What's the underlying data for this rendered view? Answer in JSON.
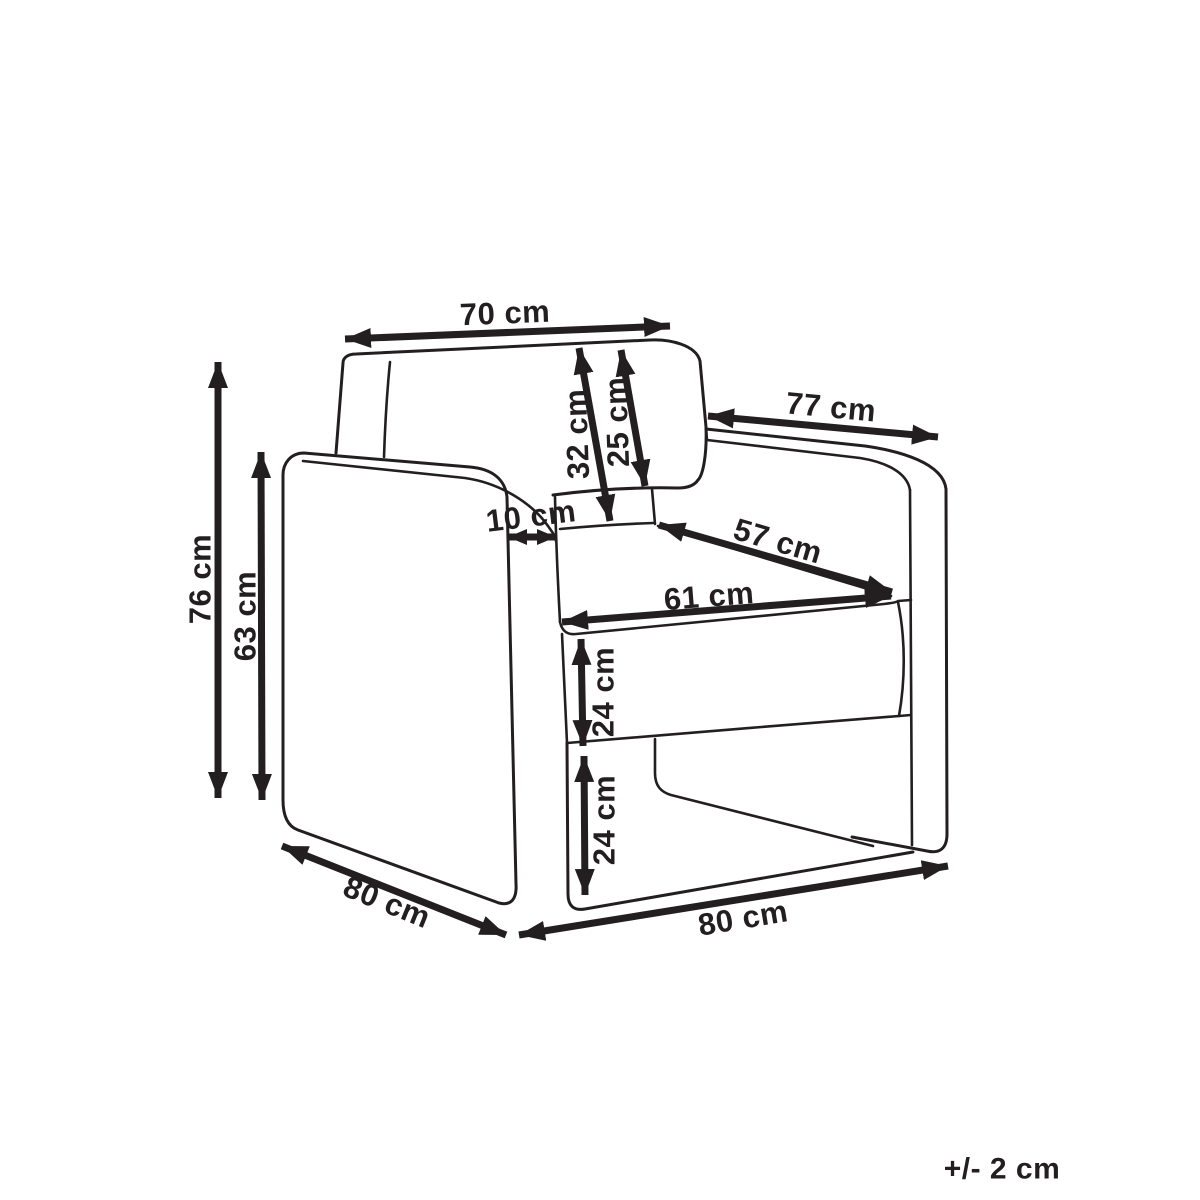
{
  "diagram": {
    "type": "furniture-dimension-drawing",
    "subject": "armchair line drawing with measurements",
    "unit": "cm",
    "tolerance_note": "+/- 2 cm",
    "colors": {
      "line": "#231f20",
      "background": "#ffffff"
    },
    "dimensions": [
      {
        "name": "backrest-width",
        "label": "70 cm"
      },
      {
        "name": "depth-along-armrest",
        "label": "77 cm"
      },
      {
        "name": "backrest-height-total",
        "label": "32 cm"
      },
      {
        "name": "backrest-panel-height",
        "label": "25 cm"
      },
      {
        "name": "armrest-thickness",
        "label": "10 cm"
      },
      {
        "name": "seat-depth",
        "label": "57 cm"
      },
      {
        "name": "seat-width",
        "label": "61 cm"
      },
      {
        "name": "seat-cushion-height",
        "label": "24 cm"
      },
      {
        "name": "under-seat-height",
        "label": "24 cm"
      },
      {
        "name": "overall-height",
        "label": "76 cm"
      },
      {
        "name": "armrest-height",
        "label": "63 cm"
      },
      {
        "name": "base-depth",
        "label": "80 cm"
      },
      {
        "name": "base-width",
        "label": "80 cm"
      }
    ]
  }
}
